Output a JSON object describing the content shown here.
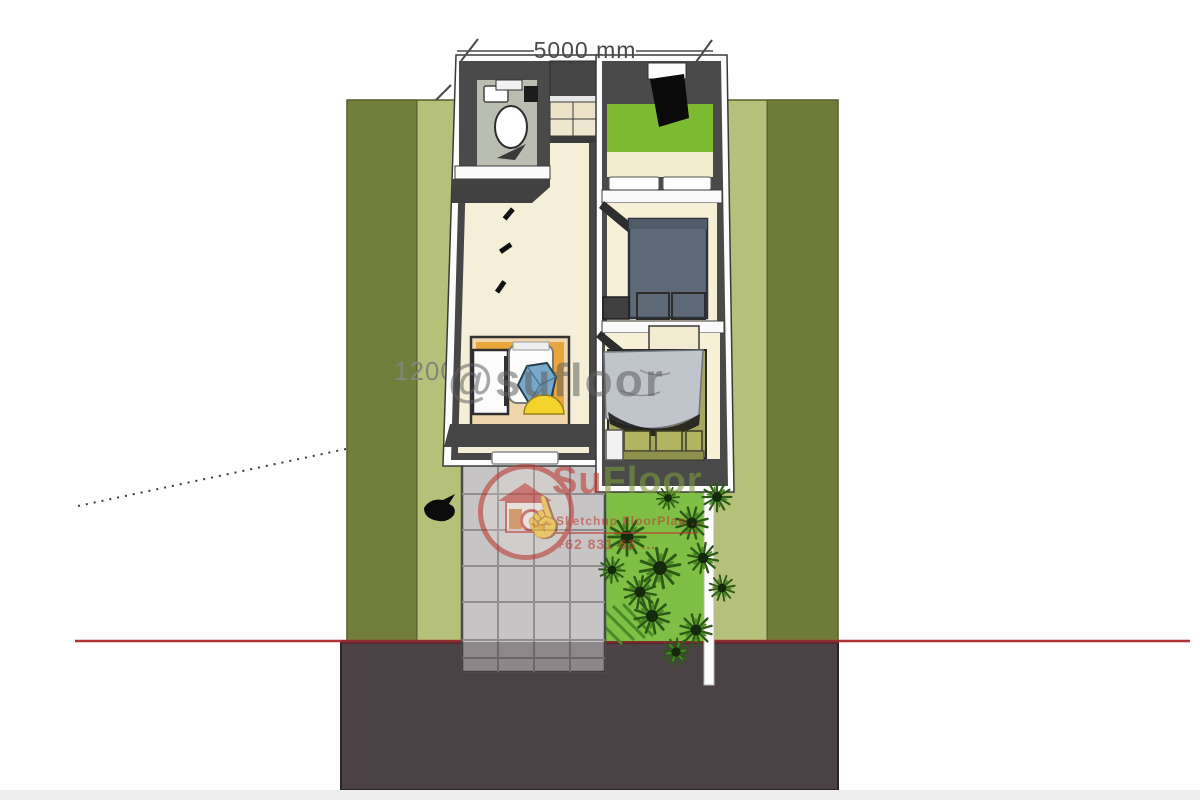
{
  "annotations": {
    "width_dimension_label": "5000 mm",
    "side_dimension_label": "1200"
  },
  "watermarks": {
    "handle_text": "@sufloor",
    "logo": {
      "brand_red": "Su",
      "brand_green": "Floor",
      "tagline": "Sketchup FloorPlan ...",
      "phone": "+62 831 63 ..."
    }
  },
  "palette": {
    "lot_dark_green": "#6f7c3a",
    "lot_light_green": "#b5c178",
    "garden_green": "#7fbf45",
    "road_gray": "#4b4245",
    "property_red_line": "#b03338",
    "wall_dark": "#4a4a4a",
    "floor_cream": "#f6efd7",
    "bed_green": "#7cba32",
    "bed_blue_gray": "#5d6977",
    "bed_gray_blanket": "#c0c4cb",
    "kitchen_orange": "#e9a63d",
    "driveway_gray": "#c6c4c5",
    "watermark_red": "#bf3a31"
  },
  "icons": [
    "toilet-icon",
    "sink-icon",
    "wardrobe-icon",
    "tv-icon",
    "bed-icon",
    "nightstand-icon",
    "fridge-icon",
    "dining-chair-icon",
    "kitchen-sink-icon",
    "shrub-icon",
    "bird-icon",
    "house-logo-icon",
    "hand-cursor-icon"
  ]
}
